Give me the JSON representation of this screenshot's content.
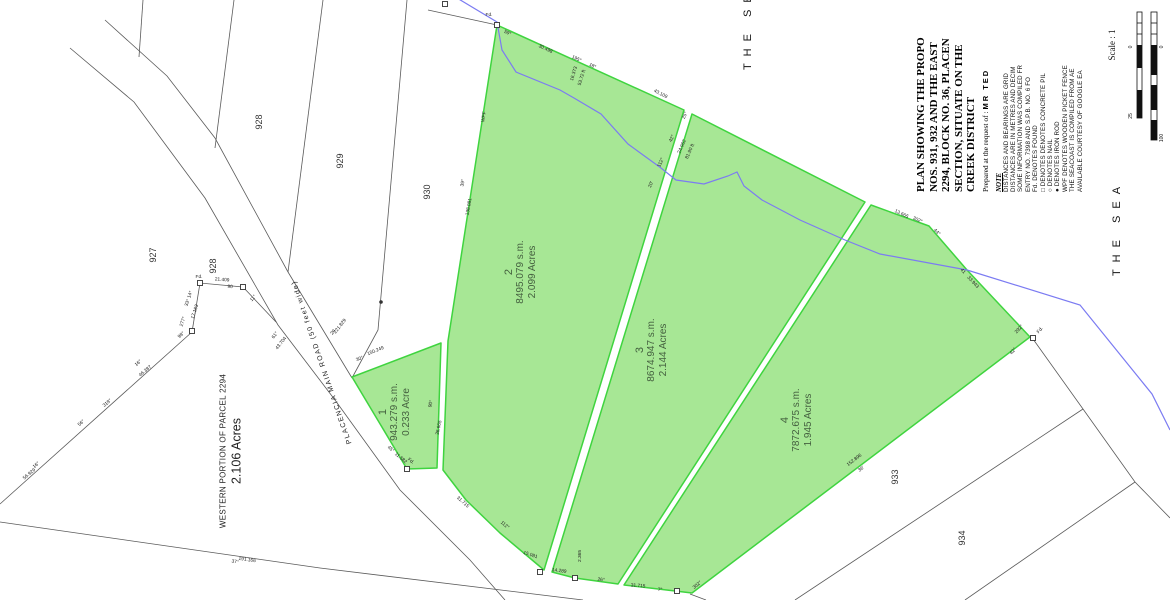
{
  "title_block": {
    "line1": "PLAN SHOWING THE PROPO",
    "line2": "NOS. 931, 932 AND THE EAST",
    "line3": "2294, BLOCK NO. 36, PLACEN",
    "line4": "SECTION, SITUATE ON THE",
    "line5": "CREEK DISTRICT",
    "prepared": "Prepared at the request of :",
    "client": "MR TED"
  },
  "note": {
    "heading": "NOTE",
    "lines": [
      "DISTANCES AND BEARINGS ARE GRID",
      "DISTANCES ARE IN METRES AND DECIM",
      "SOME INFORMATION WAS COMPILED FR",
      "ENTRY NO. 7398 AND S.P.B. NO. 6 FO",
      "Fd. DENOTES FOUND",
      "□ DENOTES DENOTES CONCRETE PIL",
      "○ DENOTES NAIL",
      "● DENOTES IRON ROD",
      "WPF DENOTES WOODEN PICKET FENCE",
      "THE SEACOAST IS COMPILED FROM AE",
      "AVAILABLE COURTESY OF GOOGLE EA"
    ]
  },
  "scale": {
    "label": "Scale : 1",
    "ticks": [
      {
        "t": "0",
        "x": 1132,
        "y": 47
      },
      {
        "t": "25",
        "x": 1132,
        "y": 116
      },
      {
        "t": "0",
        "x": 1163,
        "y": 47
      },
      {
        "t": "100",
        "x": 1163,
        "y": 138
      }
    ]
  },
  "sea": {
    "top": "THE SEA",
    "right": "THE SEA"
  },
  "western": {
    "line1": "WESTERN PORTION OF PARCEL 2294",
    "line2": "2.106 Acres"
  },
  "road": {
    "label": "PLACENCIA  MAIN  ROAD   (50 feet wide)"
  },
  "parcels": [
    {
      "id": "1",
      "area_sm": "943.279 s.m.",
      "area_ac": "0.233 Acre"
    },
    {
      "id": "2",
      "area_sm": "8495.079 s.m.",
      "area_ac": "2.099 Acres"
    },
    {
      "id": "3",
      "area_sm": "8674.947 s.m.",
      "area_ac": "2.144 Acres"
    },
    {
      "id": "4",
      "area_sm": "7872.675 s.m.",
      "area_ac": "1.945 Acres"
    }
  ],
  "neighbor_parcels": [
    {
      "t": "927",
      "x": 156,
      "y": 255
    },
    {
      "t": "928",
      "x": 262,
      "y": 122
    },
    {
      "t": "929",
      "x": 343,
      "y": 161
    },
    {
      "t": "930",
      "x": 430,
      "y": 192
    },
    {
      "t": "928",
      "x": 216,
      "y": 266
    },
    {
      "t": "933",
      "x": 898,
      "y": 477
    },
    {
      "t": "934",
      "x": 965,
      "y": 538
    }
  ],
  "micro_labels": [
    {
      "t": "59°",
      "x": 507,
      "y": 34,
      "r": 25
    },
    {
      "t": "Fd.",
      "x": 489,
      "y": 16,
      "r": 0
    },
    {
      "t": "30.498",
      "x": 545,
      "y": 50,
      "r": 25
    },
    {
      "t": "195°",
      "x": 576,
      "y": 60,
      "r": 25
    },
    {
      "t": "18°",
      "x": 592,
      "y": 67,
      "r": 25
    },
    {
      "t": "16.373",
      "x": 575,
      "y": 74,
      "r": -73
    },
    {
      "t": "53.72 ft",
      "x": 583,
      "y": 78,
      "r": -73
    },
    {
      "t": "43.109",
      "x": 660,
      "y": 95,
      "r": 27
    },
    {
      "t": "25°",
      "x": 686,
      "y": 116,
      "r": -66
    },
    {
      "t": "42°",
      "x": 673,
      "y": 139,
      "r": -66
    },
    {
      "t": "24.962",
      "x": 683,
      "y": 147,
      "r": -66
    },
    {
      "t": "81.90 ft",
      "x": 691,
      "y": 152,
      "r": -66
    },
    {
      "t": "112°",
      "x": 662,
      "y": 163,
      "r": -66
    },
    {
      "t": "20'",
      "x": 652,
      "y": 185,
      "r": -66
    },
    {
      "t": "13.665",
      "x": 901,
      "y": 215,
      "r": 26
    },
    {
      "t": "302°",
      "x": 917,
      "y": 221,
      "r": 26
    },
    {
      "t": "44°",
      "x": 936,
      "y": 233,
      "r": 45
    },
    {
      "t": "41",
      "x": 962,
      "y": 272,
      "r": 47
    },
    {
      "t": "33.943",
      "x": 972,
      "y": 283,
      "r": 47
    },
    {
      "t": "292°",
      "x": 1020,
      "y": 330,
      "r": -48
    },
    {
      "t": "42°",
      "x": 1014,
      "y": 352,
      "r": -48
    },
    {
      "t": "Fd.",
      "x": 1041,
      "y": 331,
      "r": -48
    },
    {
      "t": "152.896",
      "x": 855,
      "y": 461,
      "r": -37
    },
    {
      "t": "36'",
      "x": 862,
      "y": 470,
      "r": -37
    },
    {
      "t": "31.715",
      "x": 462,
      "y": 503,
      "r": 42
    },
    {
      "t": "112°",
      "x": 504,
      "y": 526,
      "r": 40
    },
    {
      "t": "15.081",
      "x": 530,
      "y": 556,
      "r": 18
    },
    {
      "t": "14.289",
      "x": 559,
      "y": 572,
      "r": 8
    },
    {
      "t": "2.365",
      "x": 581,
      "y": 556,
      "r": -90
    },
    {
      "t": "26°",
      "x": 601,
      "y": 581,
      "r": 6
    },
    {
      "t": "31.715",
      "x": 638,
      "y": 587,
      "r": 4
    },
    {
      "t": "7°",
      "x": 660,
      "y": 591,
      "r": 4
    },
    {
      "t": "302°",
      "x": 698,
      "y": 586,
      "r": -40
    },
    {
      "t": "36.665",
      "x": 440,
      "y": 428,
      "r": -78
    },
    {
      "t": "90°",
      "x": 432,
      "y": 404,
      "r": -78
    },
    {
      "t": "11.582",
      "x": 400,
      "y": 459,
      "r": 40
    },
    {
      "t": "45°",
      "x": 390,
      "y": 450,
      "r": 40
    },
    {
      "t": "Fd.",
      "x": 410,
      "y": 462,
      "r": 40
    },
    {
      "t": "150.249",
      "x": 376,
      "y": 352,
      "r": -22
    },
    {
      "t": "30°",
      "x": 360,
      "y": 360,
      "r": -22
    },
    {
      "t": "WPF",
      "x": 485,
      "y": 117,
      "r": -80
    },
    {
      "t": "39°",
      "x": 464,
      "y": 183,
      "r": -80
    },
    {
      "t": "138.081",
      "x": 470,
      "y": 207,
      "r": -80
    },
    {
      "t": "221.829",
      "x": 341,
      "y": 327,
      "r": -52
    },
    {
      "t": "20",
      "x": 334,
      "y": 333,
      "r": -52
    },
    {
      "t": "43.704",
      "x": 282,
      "y": 344,
      "r": -52
    },
    {
      "t": "61°",
      "x": 276,
      "y": 336,
      "r": -52
    },
    {
      "t": "56.929",
      "x": 30,
      "y": 475,
      "r": -40
    },
    {
      "t": "16°",
      "x": 37,
      "y": 466,
      "r": -40
    },
    {
      "t": "56°",
      "x": 82,
      "y": 424,
      "r": -40
    },
    {
      "t": "318°",
      "x": 108,
      "y": 404,
      "r": -40
    },
    {
      "t": "46.387",
      "x": 146,
      "y": 372,
      "r": -40
    },
    {
      "t": "16°",
      "x": 139,
      "y": 364,
      "r": -40
    },
    {
      "t": "98°",
      "x": 182,
      "y": 336,
      "r": -40
    },
    {
      "t": "17.163",
      "x": 196,
      "y": 312,
      "r": -72
    },
    {
      "t": "33°  14°",
      "x": 190,
      "y": 299,
      "r": -72
    },
    {
      "t": "277°",
      "x": 184,
      "y": 322,
      "r": -72
    },
    {
      "t": "21.409",
      "x": 222,
      "y": 281,
      "r": 4
    },
    {
      "t": "90",
      "x": 230,
      "y": 288,
      "r": 4
    },
    {
      "t": "11°",
      "x": 254,
      "y": 299,
      "r": -48
    },
    {
      "t": "Fd.",
      "x": 199,
      "y": 278,
      "r": 0
    },
    {
      "t": "191.166",
      "x": 247,
      "y": 561,
      "r": 8
    },
    {
      "t": "37°",
      "x": 235,
      "y": 563,
      "r": 8
    }
  ],
  "markers": {
    "squares": [
      [
        497,
        25
      ],
      [
        445,
        4
      ],
      [
        1033,
        338
      ],
      [
        407,
        469
      ],
      [
        540,
        572
      ],
      [
        575,
        578
      ],
      [
        677,
        591
      ],
      [
        192,
        331
      ],
      [
        200,
        283
      ],
      [
        243,
        287
      ]
    ],
    "dots": [
      [
        381,
        302
      ]
    ]
  },
  "colors": {
    "parcel_fill": "#a7e795",
    "parcel_stroke": "#3fd43f",
    "sea_line": "#7b7bf2",
    "boundary": "#5a5a5a",
    "parcel_text": "#44603f",
    "label": "#1a1a1a"
  }
}
